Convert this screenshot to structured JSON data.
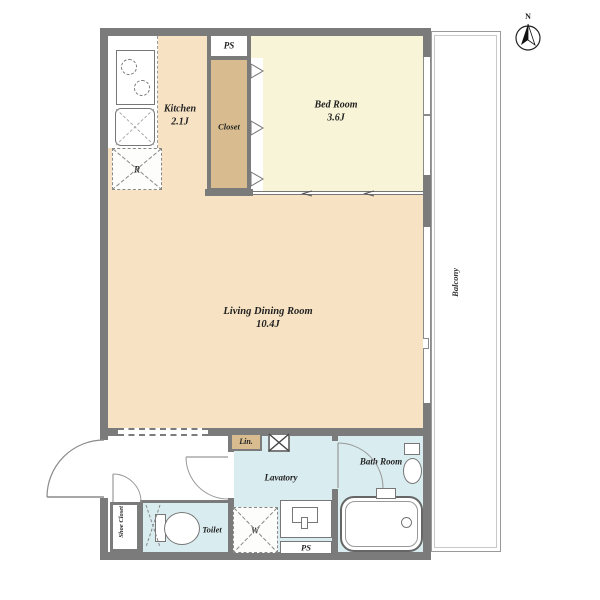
{
  "plan_title": "1LDK apartment floor plan",
  "colors": {
    "wall": "#7b7b7b",
    "floor_ldk": "#f7e3c3",
    "floor_bedroom": "#f8f4d7",
    "closet_tan": "#d8bc8f",
    "wet_area_blue": "#d9ecef",
    "line": "#888888"
  },
  "rooms": {
    "kitchen": {
      "name": "Kitchen",
      "size": "2.1J"
    },
    "bedroom": {
      "name": "Bed Room",
      "size": "3.6J"
    },
    "living": {
      "name": "Living Dining Room",
      "size": "10.4J"
    },
    "closet": {
      "name": "Closet"
    },
    "lavatory": {
      "name": "Lavatory"
    },
    "bathroom": {
      "name": "Bath Room"
    },
    "toilet": {
      "name": "Toilet"
    },
    "shoe_closet": {
      "name": "Shoe Closet"
    },
    "linen": {
      "name": "Lin."
    },
    "balcony": {
      "name": "Balcony"
    }
  },
  "labels": {
    "ps_top": "PS",
    "ps_bottom": "PS",
    "washer": "W",
    "refrigerator": "R",
    "north": "N"
  }
}
